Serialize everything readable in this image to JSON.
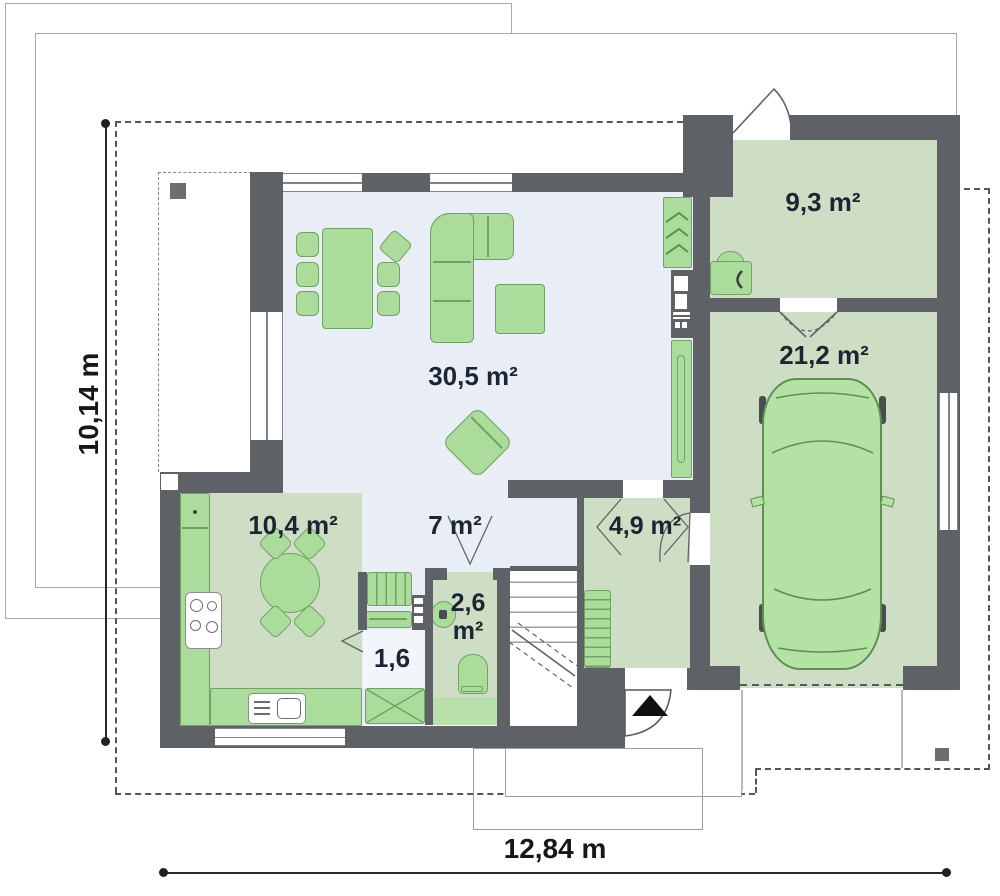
{
  "plan": {
    "rooms": {
      "living": {
        "label": "30,5 m²"
      },
      "kitchen": {
        "label": "10,4 m²"
      },
      "hall": {
        "label": "7 m²"
      },
      "pantry": {
        "label": "1,6"
      },
      "wc": {
        "label": "2,6 m²"
      },
      "vestibule": {
        "label": "4,9 m²"
      },
      "utility": {
        "label": "9,3 m²"
      },
      "garage": {
        "label": "21,2 m²"
      }
    },
    "dimensions": {
      "total_width": "12,84 m",
      "total_height": "10,14 m"
    },
    "colors": {
      "wall": "#5e6165",
      "floor_open": "#e8edf6",
      "floor_room": "#cddec5",
      "furniture_green": "#abdc9b",
      "car_green": "#b4e1a4"
    }
  }
}
